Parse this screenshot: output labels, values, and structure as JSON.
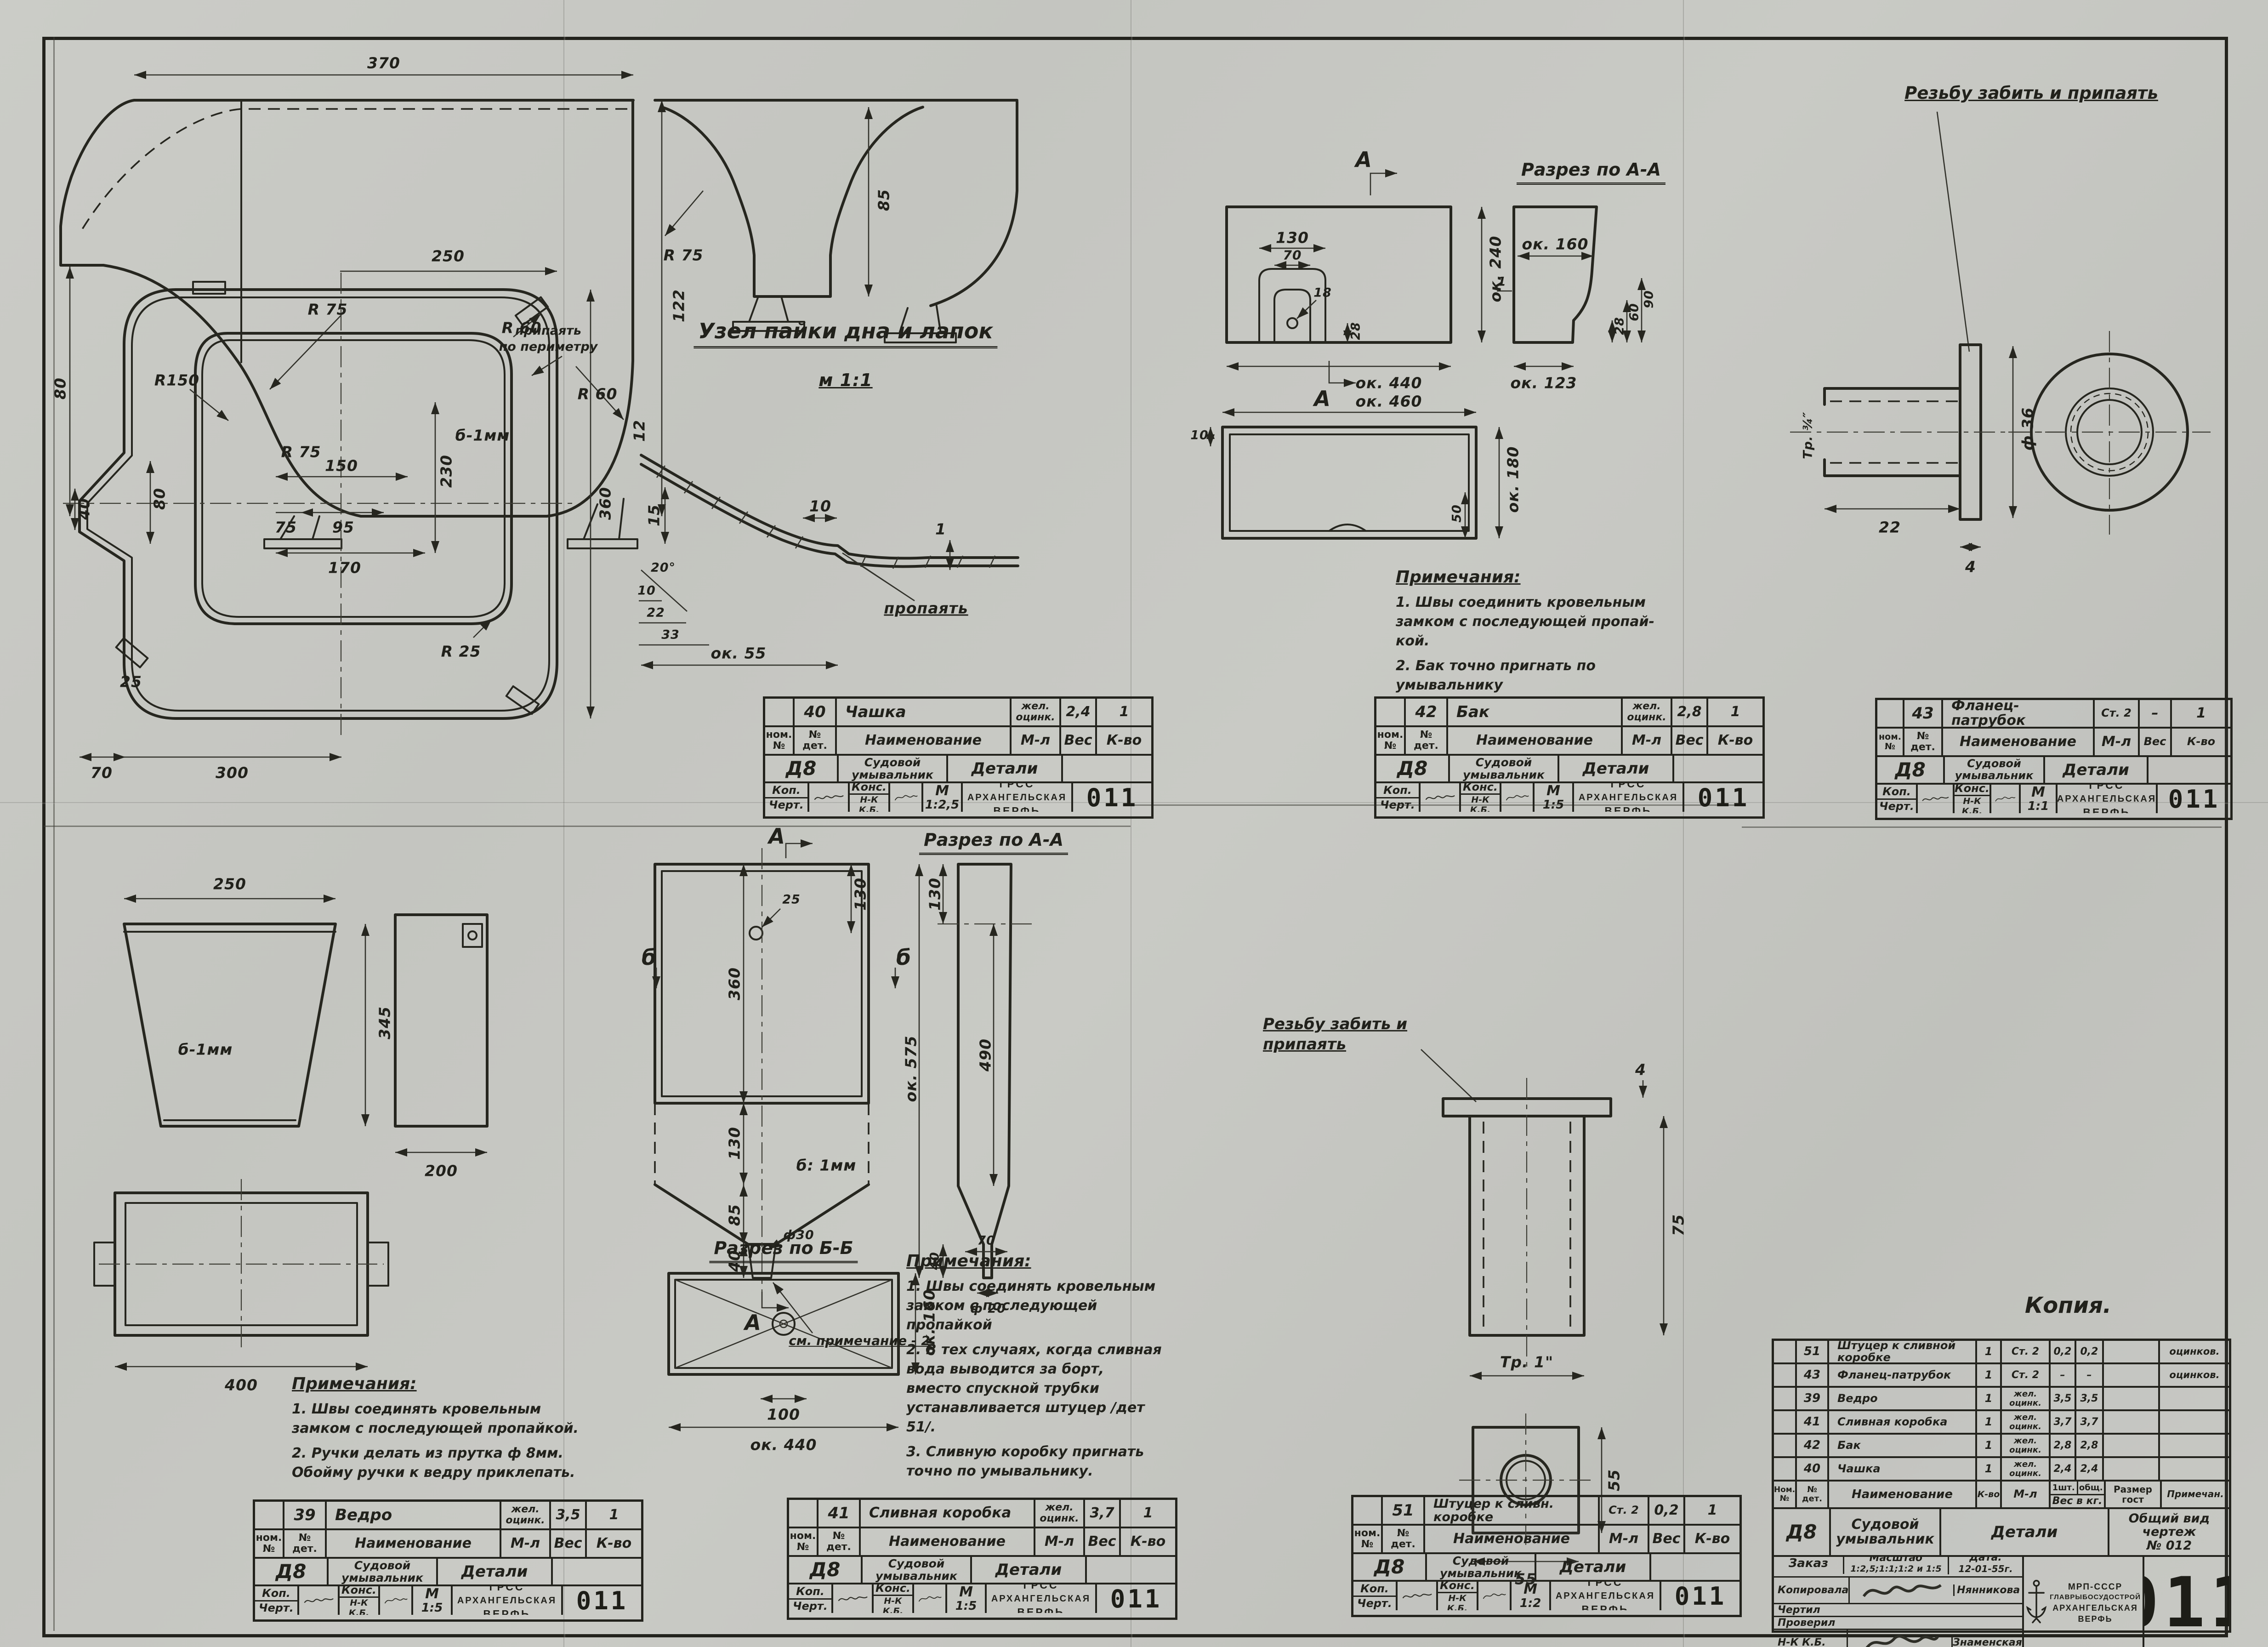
{
  "sheet": {
    "number": "011",
    "copy": "Копия.",
    "series": "Д8",
    "product": "Судовой\nумывальник",
    "sheet_title": "Детали"
  },
  "org": {
    "grss": "ГРСС",
    "yard1": "АРХАНГЕЛЬСКАЯ",
    "yard2": "ВЕРФЬ",
    "ministry": "МРП-СССР",
    "glavk": "ГЛАВРЫБОСУДОСТРОЙ"
  },
  "tb": {
    "nom": "ном.\n№",
    "det": "№\nдет.",
    "name": "Наименование",
    "ml": "М-л",
    "ves": "Вес",
    "kvo": "К-во",
    "kop": "Коп.",
    "chert": "Черт.",
    "kons": "Конс.",
    "nk": "Н-К\nК.Б.",
    "m": "М"
  },
  "blocks": {
    "b40": {
      "pos": "40",
      "name": "Чашка",
      "mat": "жел.\nоцинк.",
      "ves": "2,4",
      "kvo": "1",
      "scale": "1:2,5"
    },
    "b42": {
      "pos": "42",
      "name": "Бак",
      "mat": "жел.\nоцинк.",
      "ves": "2,8",
      "kvo": "1",
      "scale": "1:5"
    },
    "b43": {
      "pos": "43",
      "name": "Фланец-патрубок",
      "mat": "Ст. 2",
      "ves": "–",
      "kvo": "1",
      "scale": "1:1"
    },
    "b39": {
      "pos": "39",
      "name": "Ведро",
      "mat": "жел.\nоцинк.",
      "ves": "3,5",
      "kvo": "1",
      "scale": "1:5"
    },
    "b41": {
      "pos": "41",
      "name": "Сливная коробка",
      "mat": "жел.\nоцинк.",
      "ves": "3,7",
      "kvo": "1",
      "scale": "1:5"
    },
    "b51": {
      "pos": "51",
      "name": "Штуцер к сливн. коробке",
      "mat": "Ст. 2",
      "ves": "0,2",
      "kvo": "1",
      "scale": "1:2"
    }
  },
  "p": {
    "cup": {
      "a": [
        "370",
        "80",
        "122",
        "R 75",
        "R 60",
        "б-1мм"
      ],
      "b": [
        "R 75",
        "85"
      ],
      "plan": [
        "250",
        "R 60",
        "R150",
        "R 75",
        "150",
        "95",
        "75",
        "230",
        "360",
        "170",
        "80",
        "40",
        "R 25",
        "25",
        "70",
        "300"
      ],
      "plan_callout": "припаять\nпо периметру",
      "det_title": "Узел пайки дна и лапок",
      "det_scale": "м 1:1",
      "det": [
        "12",
        "15",
        "10",
        "1",
        "20°",
        "10",
        "22",
        "33",
        "ок. 55"
      ],
      "det_callout": "пропаять"
    },
    "tank": {
      "marker": "А",
      "sec_title": "Разрез по А-А",
      "front": [
        "130",
        "70",
        "18",
        "28",
        "ок. 440",
        "ок. 240"
      ],
      "sec": [
        "ок. 160",
        "1",
        "28",
        "60",
        "90",
        "ок. 123"
      ],
      "bottom": [
        "ок. 460",
        "10",
        "50",
        "ок. 180"
      ],
      "notes_title": "Примечания:",
      "notes": [
        "1. Швы соединить кровельным\nзамком с последующей пропай-\nкой.",
        "2. Бак точно пригнать по\nумывальнику"
      ]
    },
    "fl": {
      "callout": "Резьбу забить и припаять",
      "dims": [
        "ф 36",
        "22",
        "4",
        "Тр. ¾″"
      ]
    },
    "bu": {
      "dims": [
        "250",
        "345",
        "б-1мм",
        "200",
        "400"
      ],
      "notes_title": "Примечания:",
      "notes": [
        "1. Швы соединять кровельным\nзамком с последующей пропайкой.",
        "2. Ручки делать из прутка ф 8мм.\nОбойму ручки к ведру приклепать."
      ]
    },
    "db": {
      "mA": "А",
      "mB": "б",
      "sec_a": "Разрез по А-А",
      "sec_b": "Разрез по Б-Б",
      "front": [
        "25",
        "130",
        "360",
        "130",
        "85",
        "40",
        "ф30",
        "б: 1мм"
      ],
      "front_callout": "см. примечание - 2",
      "seca": [
        "130",
        "ок. 575",
        "490",
        "70",
        "40",
        "ф 20"
      ],
      "secb": [
        "ок. 160",
        "100",
        "ок. 440"
      ],
      "notes_title": "Примечания:",
      "notes": [
        "1. Швы соединять кровельным\nзамком с последующей пропайкой",
        "2. В тех случаях, когда сливная\nвода выводится за борт,\nвместо спускной трубки\nустанавливается штуцер /дет 51/.",
        "3. Сливную коробку пригнать\nточно по умывальнику."
      ]
    },
    "ft": {
      "callout": "Резьбу забить и\nприпаять",
      "dims": [
        "4",
        "75",
        "Тр. 1\"",
        "55",
        "55"
      ]
    }
  },
  "main": {
    "header": {
      "nom": "Ном.\n№",
      "det": "№\nдет.",
      "name": "Наименование",
      "kvo": "К-во",
      "ml": "М-л",
      "w1": "1шт.",
      "w2": "общ.",
      "ves": "Вес в кг.",
      "size": "Размер\nгост",
      "note": "Примечан."
    },
    "rows": [
      {
        "pos": "51",
        "name": "Штуцер к сливной коробке",
        "kvo": "1",
        "ml": "Ст. 2",
        "w1": "0,2",
        "w2": "0,2",
        "note": "оцинков."
      },
      {
        "pos": "43",
        "name": "Фланец-патрубок",
        "kvo": "1",
        "ml": "Ст. 2",
        "w1": "–",
        "w2": "–",
        "note": "оцинков."
      },
      {
        "pos": "39",
        "name": "Ведро",
        "kvo": "1",
        "ml": "жел.\nоцинк.",
        "w1": "3,5",
        "w2": "3,5",
        "note": ""
      },
      {
        "pos": "41",
        "name": "Сливная коробка",
        "kvo": "1",
        "ml": "жел.\nоцинк.",
        "w1": "3,7",
        "w2": "3,7",
        "note": ""
      },
      {
        "pos": "42",
        "name": "Бак",
        "kvo": "1",
        "ml": "жел.\nоцинк.",
        "w1": "2,8",
        "w2": "2,8",
        "note": ""
      },
      {
        "pos": "40",
        "name": "Чашка",
        "kvo": "1",
        "ml": "жел.\nоцинк.",
        "w1": "2,4",
        "w2": "2,4",
        "note": ""
      }
    ],
    "view_cell": "Общий вид\nчертеж\n№ 012",
    "zakaz": "Заказ",
    "masshtab_l": "Масштаб",
    "masshtab": "1:2,5;1:1;1:2 и 1:5",
    "data_l": "Дата.",
    "date": "12-01-55г.",
    "kopirovala": "Копировала",
    "kop_name": "Нянникова",
    "chertil": "Чертил",
    "proveril": "Проверил",
    "nk": "Н-К К.Б.",
    "nk_name": "Знаменская"
  }
}
